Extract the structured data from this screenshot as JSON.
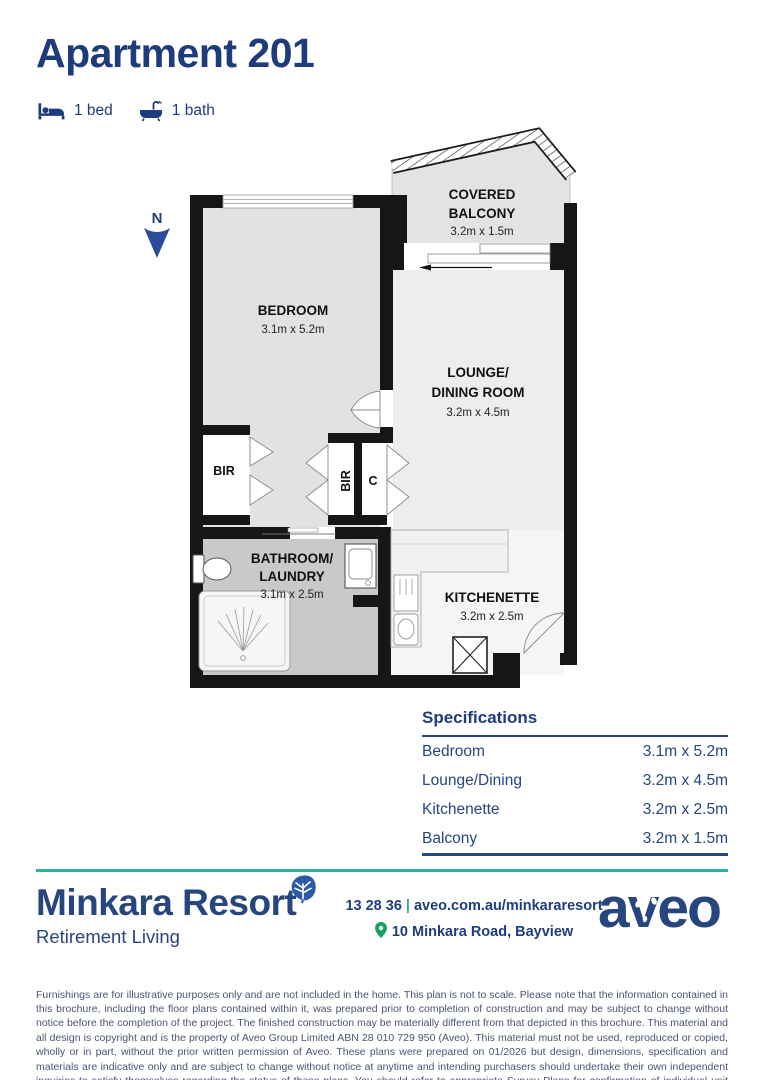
{
  "header": {
    "title": "Apartment 201",
    "bed_label": "1 bed",
    "bath_label": "1 bath"
  },
  "plan": {
    "north": "N",
    "balcony_line1": "COVERED",
    "balcony_line2": "BALCONY",
    "balcony_dims": "3.2m x 1.5m",
    "bedroom": "BEDROOM",
    "bedroom_dims": "3.1m x 5.2m",
    "lounge_line1": "LOUNGE/",
    "lounge_line2": "DINING ROOM",
    "lounge_dims": "3.2m x 4.5m",
    "bathroom_line1": "BATHROOM/",
    "bathroom_line2": "LAUNDRY",
    "bathroom_dims": "3.1m x 2.5m",
    "kitchenette": "KITCHENETTE",
    "kitchenette_dims": "3.2m x 2.5m",
    "bir_left": "BIR",
    "bir_middle": "BIR",
    "cupboard": "C"
  },
  "specifications": {
    "title": "Specifications",
    "rows": [
      {
        "label": "Bedroom",
        "value": "3.1m x 5.2m"
      },
      {
        "label": "Lounge/Dining",
        "value": "3.2m x 4.5m"
      },
      {
        "label": "Kitchenette",
        "value": "3.2m x 2.5m"
      },
      {
        "label": "Balcony",
        "value": "3.2m x 1.5m"
      }
    ]
  },
  "footer": {
    "brand": "Minkara Resort",
    "tagline": "Retirement Living",
    "phone": "13 28 36",
    "separator": "|",
    "website": "aveo.com.au/minkararesort",
    "address": "10 Minkara Road, Bayview",
    "logo_text": "aveo"
  },
  "disclaimer": "Furnishings are for illustrative purposes only and are not included in the home. This plan is not to scale. Please note that the information contained in this brochure, including the floor plans contained within it, was prepared prior to completion of construction and may be subject to change without notice before the completion of the project. The finished construction may be materially different from that depicted in this brochure. This material and all design is copyright and is the property of Aveo Group Limited ABN 28 010 729 950 (Aveo). This material must not be used, reproduced or copied, wholly or in part, without the prior written permission of Aveo. These plans were prepared on 01/2026 but design, dimensions, specification and materials are indicative only and are subject to change without notice at anytime and intending purchasers should undertake their own independent inquiries to satisfy themselves regarding the status of these plans. You should refer to appropriate Survey Plans for confirmation of individual unit areas.",
  "colors": {
    "navy": "#27457F",
    "teal": "#2FB09A",
    "pin_green": "#16A35F"
  }
}
